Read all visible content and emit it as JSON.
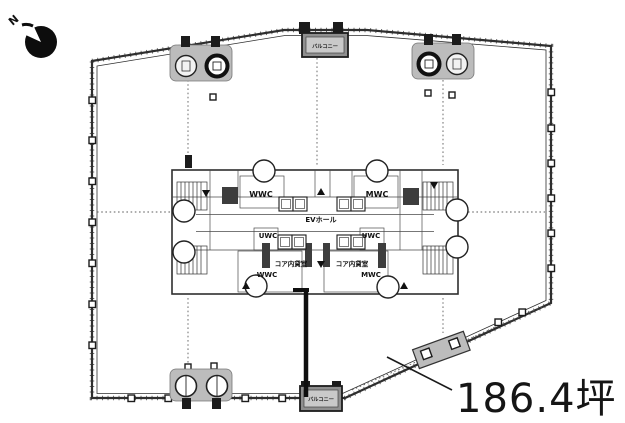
{
  "compass": {
    "north_label": "N"
  },
  "floor_plan": {
    "area_label": "186.4坪",
    "balconies": {
      "top": "バルコニー",
      "bottom": "バルコニー"
    },
    "core": {
      "wwc_top": "WWC",
      "mwc_top": "MWC",
      "uwc_left": "UWC",
      "uwc_right": "UWC",
      "ev_hall": "EVホール",
      "rental_left": "コア内貸室",
      "rental_right": "コア内貸室",
      "wwc_bottom": "WWC",
      "mwc_bottom": "MWC"
    },
    "colors": {
      "line": "#2e2e2e",
      "balcony_fill": "#8f8f8f",
      "tower_fill": "#bcbcbc",
      "text": "#111111"
    }
  }
}
